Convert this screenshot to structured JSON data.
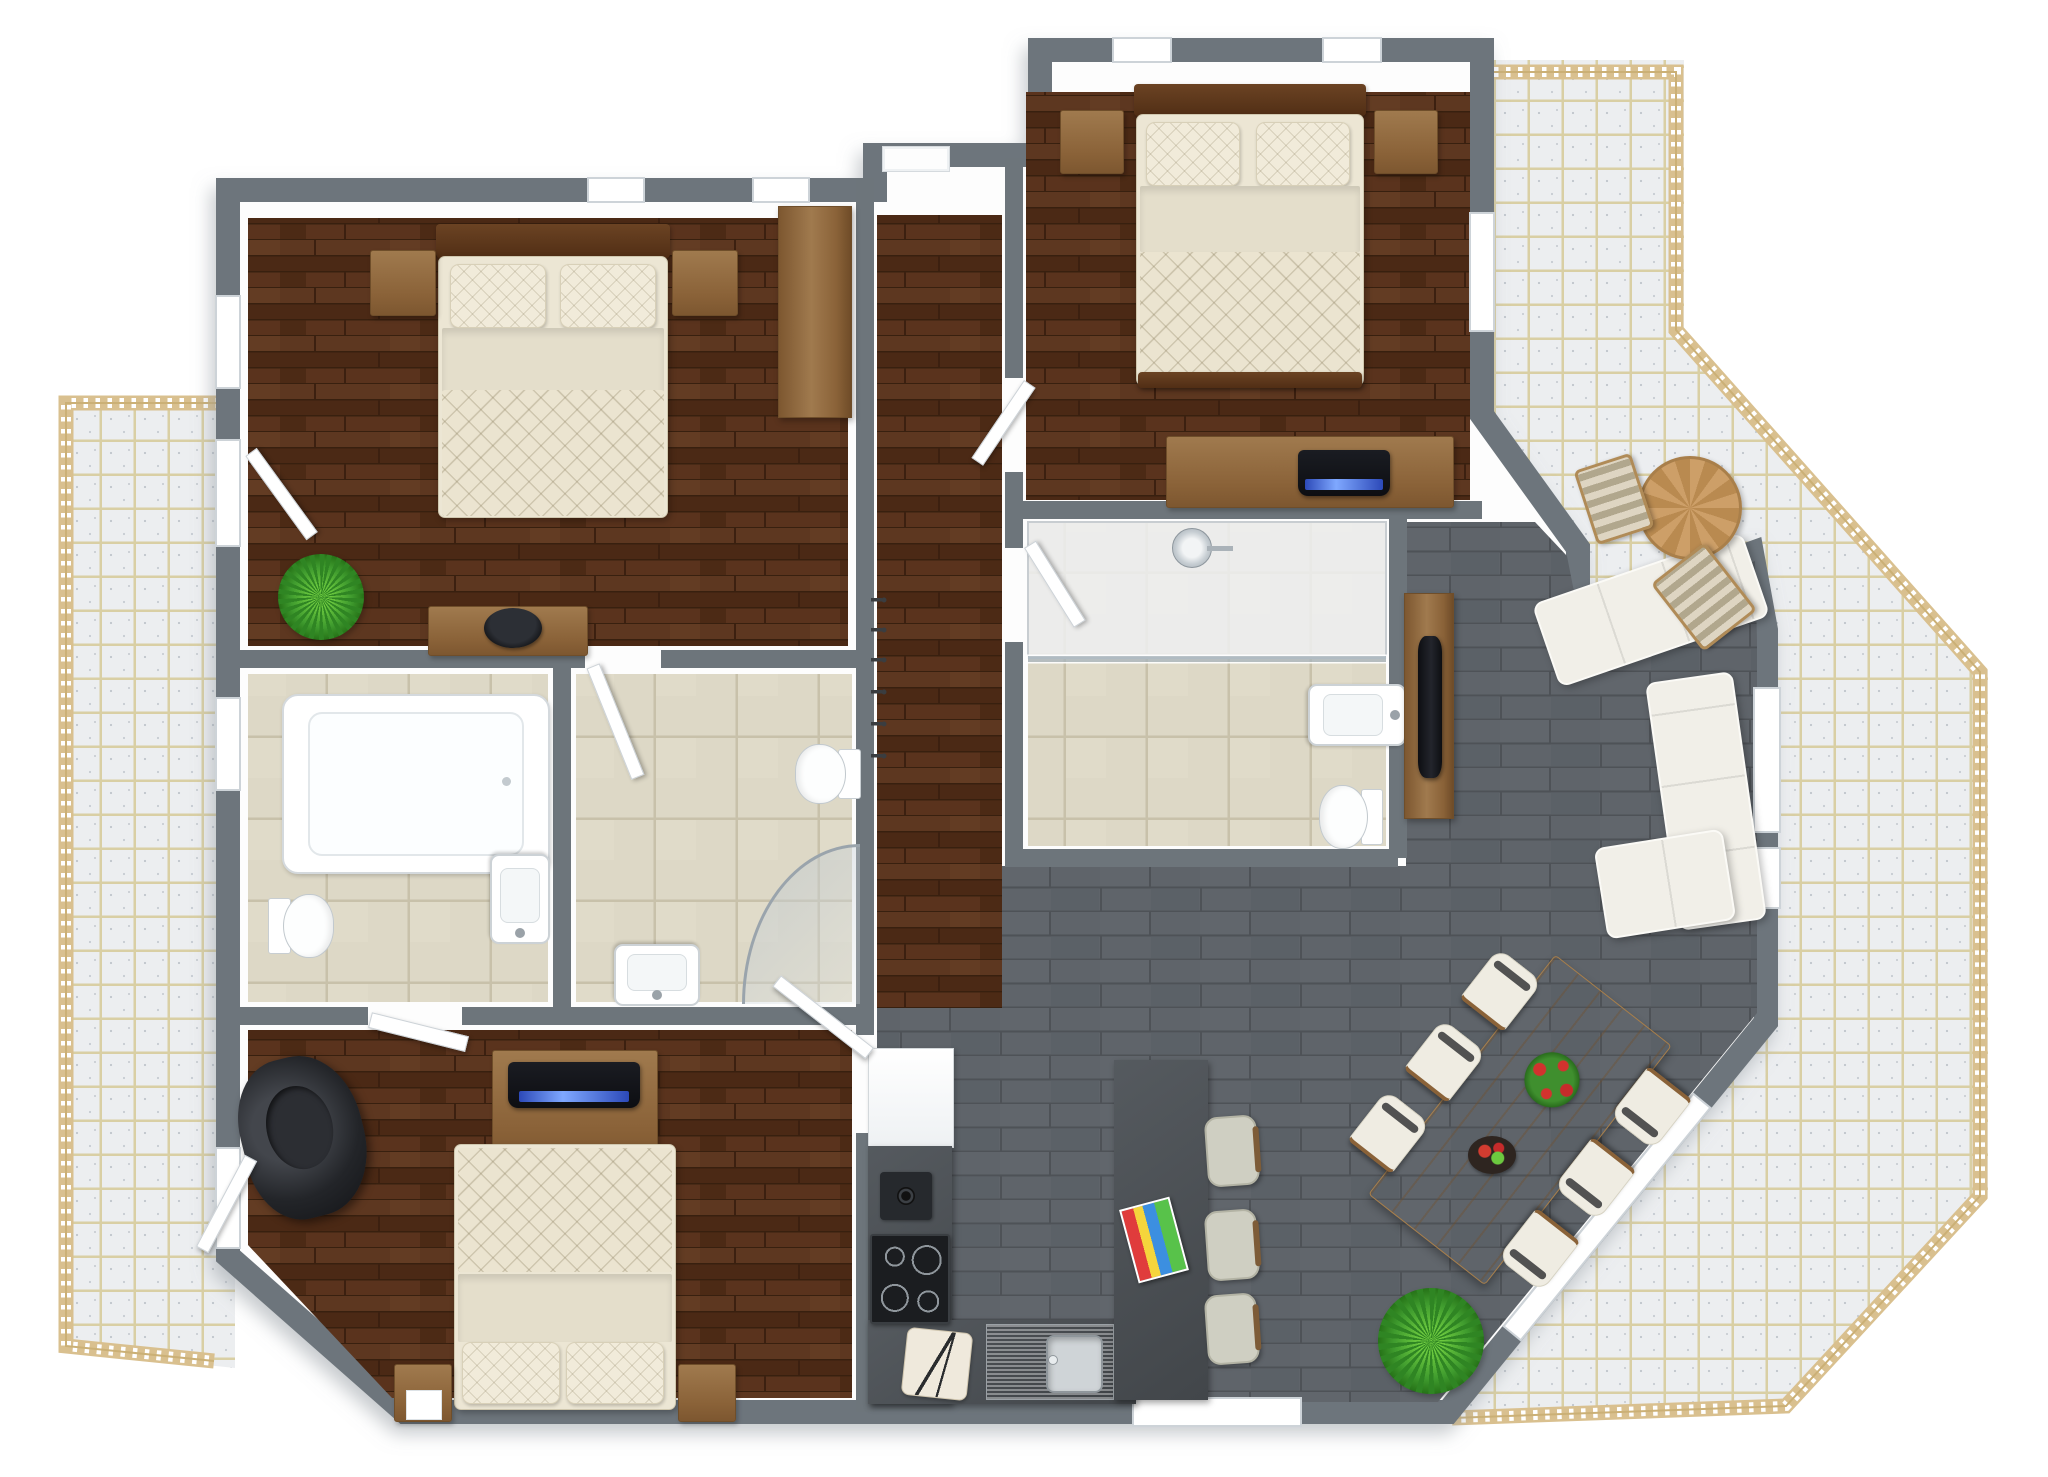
{
  "meta": {
    "title": "3D apartment floor plan render, top-down view",
    "style": "photorealistic 3D floor plan on white background, no text labels"
  },
  "palette": {
    "wall_gray": "#6d757b",
    "inner_wall_white": "#fdfdfd",
    "bedroom_wood_floor": "#54301c",
    "living_tile_gray": "#5f646a",
    "bathroom_tile_beige": "#ddd8c6",
    "balcony_glass_block": "#eceef0",
    "balcony_grout_tan": "#d9cfa4",
    "railing_wood": "#d9c08f",
    "bedding_cream": "#ebe4d0",
    "furniture_wood": "#9a7246",
    "dark_headboard_wood": "#5e3a22",
    "kitchen_counter_dark": "#4a4e52",
    "sofa_cream": "#f1efe8",
    "tv_screen_blue": "#3a58c8",
    "plant_green": "#3f9b2e",
    "black_armchair": "#1f2124"
  },
  "rooms": [
    {
      "id": "bedroom-top-left",
      "floor": "dark wood",
      "contents": "double bed, two nightstands, wardrobe, dresser with bowl, plant"
    },
    {
      "id": "bedroom-top-right",
      "floor": "dark wood",
      "contents": "double bed, two nightstands, desk with laptop"
    },
    {
      "id": "bedroom-bottom-left",
      "floor": "dark wood",
      "contents": "double bed, two nightstands, TV sideboard, black armchair"
    },
    {
      "id": "bathroom-left",
      "floor": "beige tile",
      "contents": "bathtub, toilet, sink"
    },
    {
      "id": "bathroom-middle",
      "floor": "beige tile",
      "contents": "corner shower, toilet, sink, door"
    },
    {
      "id": "bathroom-right",
      "floor": "beige tile",
      "contents": "walk-in shower, sink, toilet"
    },
    {
      "id": "hallway",
      "floor": "dark wood",
      "contents": "entry door, coat hooks"
    },
    {
      "id": "kitchen-living-dining",
      "floor": "gray tile",
      "contents": "kitchen counter, fridge, cooktop, sink, island with 3 stools and magazines, dining table with 6 chairs, corner sofa, TV cabinet, plants"
    },
    {
      "id": "balconies",
      "floor": "glass-block tile",
      "contents": "wood railing, round table with two striped chairs"
    }
  ],
  "scene": {
    "items": [
      {
        "n": "bed-1-headboard",
        "t": "wood-dark",
        "x": 436,
        "y": 224,
        "w": 234,
        "h": 34
      },
      {
        "n": "bed-1-mattress",
        "t": "mattress",
        "x": 438,
        "y": 256,
        "w": 230,
        "h": 262
      },
      {
        "n": "bed-1-pillow-left",
        "t": "pillow",
        "x": 450,
        "y": 264,
        "w": 96,
        "h": 64
      },
      {
        "n": "bed-1-pillow-right",
        "t": "pillow",
        "x": 560,
        "y": 264,
        "w": 96,
        "h": 64
      },
      {
        "n": "bed-1-sheet",
        "t": "sheet",
        "x": 442,
        "y": 328,
        "w": 222,
        "h": 64
      },
      {
        "n": "bed-1-quilt",
        "t": "quilt",
        "x": 442,
        "y": 390,
        "w": 222,
        "h": 126
      },
      {
        "n": "nightstand-bed1-left",
        "t": "wood",
        "x": 370,
        "y": 250,
        "w": 66,
        "h": 66
      },
      {
        "n": "nightstand-bed1-right",
        "t": "wood",
        "x": 672,
        "y": 250,
        "w": 66,
        "h": 66
      },
      {
        "n": "wardrobe-bedroom1",
        "t": "wood-v",
        "x": 778,
        "y": 206,
        "w": 74,
        "h": 212
      },
      {
        "n": "dresser-bedroom1",
        "t": "wood",
        "x": 428,
        "y": 606,
        "w": 160,
        "h": 50
      },
      {
        "n": "decor-bowl-bedroom1",
        "t": "dark-bowl",
        "x": 484,
        "y": 608,
        "w": 58,
        "h": 40
      },
      {
        "n": "plant-bedroom1",
        "t": "plant",
        "x": 278,
        "y": 554,
        "w": 86,
        "h": 86
      },
      {
        "n": "bed-2-headboard",
        "t": "wood-dark",
        "x": 1134,
        "y": 84,
        "w": 232,
        "h": 32
      },
      {
        "n": "bed-2-mattress",
        "t": "mattress",
        "x": 1136,
        "y": 114,
        "w": 228,
        "h": 272
      },
      {
        "n": "bed-2-pillow-left",
        "t": "pillow",
        "x": 1146,
        "y": 122,
        "w": 94,
        "h": 64
      },
      {
        "n": "bed-2-pillow-right",
        "t": "pillow",
        "x": 1256,
        "y": 122,
        "w": 94,
        "h": 64
      },
      {
        "n": "bed-2-sheet",
        "t": "sheet",
        "x": 1140,
        "y": 186,
        "w": 220,
        "h": 66
      },
      {
        "n": "bed-2-quilt",
        "t": "quilt",
        "x": 1140,
        "y": 252,
        "w": 220,
        "h": 122
      },
      {
        "n": "bed-2-footboard",
        "t": "wood-dark",
        "x": 1138,
        "y": 372,
        "w": 224,
        "h": 16
      },
      {
        "n": "nightstand-bed2-left",
        "t": "wood",
        "x": 1060,
        "y": 110,
        "w": 64,
        "h": 64
      },
      {
        "n": "nightstand-bed2-right",
        "t": "wood",
        "x": 1374,
        "y": 110,
        "w": 64,
        "h": 64
      },
      {
        "n": "desk-bedroom2",
        "t": "wood",
        "x": 1166,
        "y": 436,
        "w": 288,
        "h": 72
      },
      {
        "n": "laptop-bedroom2",
        "t": "dark-tv",
        "x": 1298,
        "y": 450,
        "w": 92,
        "h": 46
      },
      {
        "n": "tub-bathroom-left",
        "t": "tub",
        "x": 282,
        "y": 694,
        "w": 268,
        "h": 180
      },
      {
        "n": "toilet-bathroom-left",
        "t": "toilet",
        "x": 264,
        "y": 894,
        "w": 74,
        "h": 66,
        "r": -90
      },
      {
        "n": "sink-bathroom-left",
        "t": "sink",
        "x": 490,
        "y": 854,
        "w": 60,
        "h": 90,
        "r": 180
      },
      {
        "n": "toilet-bathroom-middle",
        "t": "toilet",
        "x": 794,
        "y": 740,
        "w": 68,
        "h": 66,
        "r": 90
      },
      {
        "n": "corner-shower-bathroom-middle",
        "t": "corner-shower",
        "x": 742,
        "y": 844,
        "w": 118,
        "h": 160
      },
      {
        "n": "sink-bathroom-middle",
        "t": "sink",
        "x": 614,
        "y": 944,
        "w": 86,
        "h": 62,
        "r": 180
      },
      {
        "n": "door-leaf-bathroom-middle",
        "t": "leaf",
        "x": 586,
        "y": 666,
        "w": 14,
        "h": 120,
        "r": -22,
        "o": "50% 0%"
      },
      {
        "n": "shower-glass-bathroom-right",
        "t": "glass-h",
        "x": 1028,
        "y": 656,
        "w": 358,
        "h": 6
      },
      {
        "n": "shower-head-bathroom-right",
        "t": "shower-head",
        "x": 1172,
        "y": 528,
        "w": 40,
        "h": 40
      },
      {
        "n": "sink-bathroom-right",
        "t": "sink",
        "x": 1326,
        "y": 666,
        "w": 62,
        "h": 98,
        "r": 90
      },
      {
        "n": "toilet-bathroom-right",
        "t": "toilet",
        "x": 1314,
        "y": 784,
        "w": 74,
        "h": 64,
        "r": 90
      },
      {
        "n": "armchair-bedroom3",
        "t": "armchair",
        "x": 242,
        "y": 1056,
        "w": 122,
        "h": 162,
        "r": -14
      },
      {
        "n": "tv-stand-bedroom3",
        "t": "wood",
        "x": 492,
        "y": 1050,
        "w": 166,
        "h": 114
      },
      {
        "n": "tv-bedroom3",
        "t": "dark-tv",
        "x": 508,
        "y": 1062,
        "w": 132,
        "h": 46
      },
      {
        "n": "bed-3-mattress",
        "t": "mattress",
        "x": 454,
        "y": 1144,
        "w": 222,
        "h": 266
      },
      {
        "n": "bed-3-quilt",
        "t": "quilt",
        "x": 458,
        "y": 1148,
        "w": 214,
        "h": 124
      },
      {
        "n": "bed-3-sheet",
        "t": "sheet",
        "x": 458,
        "y": 1274,
        "w": 214,
        "h": 68
      },
      {
        "n": "bed-3-pillow-left",
        "t": "pillow",
        "x": 462,
        "y": 1342,
        "w": 98,
        "h": 62
      },
      {
        "n": "bed-3-pillow-right",
        "t": "pillow",
        "x": 566,
        "y": 1342,
        "w": 98,
        "h": 62
      },
      {
        "n": "nightstand-bed3-left",
        "t": "wood",
        "x": 394,
        "y": 1364,
        "w": 58,
        "h": 58
      },
      {
        "n": "box-on-nightstand",
        "t": "white",
        "x": 406,
        "y": 1390,
        "w": 36,
        "h": 30
      },
      {
        "n": "nightstand-bed3-right",
        "t": "wood",
        "x": 678,
        "y": 1364,
        "w": 58,
        "h": 58
      },
      {
        "n": "fridge",
        "t": "fridge",
        "x": 868,
        "y": 1048,
        "w": 86,
        "h": 100
      },
      {
        "n": "kitchen-counter-west",
        "t": "counter",
        "x": 868,
        "y": 1146,
        "w": 84,
        "h": 258
      },
      {
        "n": "kitchen-counter-south",
        "t": "counter",
        "x": 868,
        "y": 1320,
        "w": 268,
        "h": 84
      },
      {
        "n": "coffee-machine",
        "t": "coffee",
        "x": 880,
        "y": 1172,
        "w": 52,
        "h": 48
      },
      {
        "n": "cooktop",
        "t": "cooktop",
        "x": 870,
        "y": 1234,
        "w": 80,
        "h": 90
      },
      {
        "n": "cutting-board",
        "t": "board",
        "x": 904,
        "y": 1330,
        "w": 66,
        "h": 68,
        "r": 6
      },
      {
        "n": "kitchen-sink",
        "t": "ksink",
        "x": 986,
        "y": 1324,
        "w": 128,
        "h": 76
      },
      {
        "n": "kitchen-island",
        "t": "counter",
        "x": 1114,
        "y": 1060,
        "w": 94,
        "h": 340
      },
      {
        "n": "magazines",
        "t": "mags",
        "x": 1128,
        "y": 1202,
        "w": 52,
        "h": 76,
        "r": -15
      },
      {
        "n": "bar-stool-1",
        "t": "stool",
        "x": 1206,
        "y": 1116,
        "w": 52,
        "h": 70,
        "r": -4
      },
      {
        "n": "bar-stool-2",
        "t": "stool",
        "x": 1206,
        "y": 1210,
        "w": 52,
        "h": 70,
        "r": -4
      },
      {
        "n": "bar-stool-3",
        "t": "stool",
        "x": 1206,
        "y": 1294,
        "w": 52,
        "h": 70,
        "r": -4
      },
      {
        "n": "tv-cabinet-living",
        "t": "wood-v",
        "x": 1404,
        "y": 593,
        "w": 50,
        "h": 226
      },
      {
        "n": "tv-living",
        "t": "tv-v",
        "x": 1418,
        "y": 636,
        "w": 24,
        "h": 142
      },
      {
        "n": "sofa-back-section",
        "t": "sofa",
        "x": 1540,
        "y": 566,
        "w": 222,
        "h": 88,
        "r": -19
      },
      {
        "n": "sofa-side-section",
        "t": "sofa-v",
        "x": 1662,
        "y": 676,
        "w": 88,
        "h": 250,
        "r": -8
      },
      {
        "n": "sofa-chaise",
        "t": "sofa",
        "x": 1600,
        "y": 838,
        "w": 130,
        "h": 92,
        "r": -9
      },
      {
        "n": "dining-table",
        "t": "table-wood",
        "x": 1446,
        "y": 968,
        "w": 148,
        "h": 304,
        "r": 38
      },
      {
        "n": "dining-chair-1",
        "t": "chair",
        "x": 1361,
        "y": 1100,
        "w": 56,
        "h": 64,
        "r": 38
      },
      {
        "n": "dining-chair-2",
        "t": "chair",
        "x": 1417,
        "y": 1029,
        "w": 56,
        "h": 64,
        "r": 38
      },
      {
        "n": "dining-chair-3",
        "t": "chair",
        "x": 1473,
        "y": 958,
        "w": 56,
        "h": 64,
        "r": 38
      },
      {
        "n": "dining-chair-4",
        "t": "chair",
        "x": 1511,
        "y": 1218,
        "w": 56,
        "h": 64,
        "r": 218
      },
      {
        "n": "dining-chair-5",
        "t": "chair",
        "x": 1567,
        "y": 1147,
        "w": 56,
        "h": 64,
        "r": 218
      },
      {
        "n": "dining-chair-6",
        "t": "chair",
        "x": 1623,
        "y": 1076,
        "w": 56,
        "h": 64,
        "r": 218
      },
      {
        "n": "table-flowers",
        "t": "flowers",
        "x": 1524,
        "y": 1052,
        "w": 56,
        "h": 58
      },
      {
        "n": "fruit-bowl",
        "t": "fruit",
        "x": 1468,
        "y": 1136,
        "w": 48,
        "h": 38
      },
      {
        "n": "plant-living",
        "t": "plant",
        "x": 1378,
        "y": 1288,
        "w": 106,
        "h": 106
      },
      {
        "n": "balcony-round-table",
        "t": "round-table",
        "x": 1638,
        "y": 456,
        "w": 104,
        "h": 104
      },
      {
        "n": "balcony-chair-1",
        "t": "bchair",
        "x": 1584,
        "y": 460,
        "w": 60,
        "h": 78,
        "r": -18
      },
      {
        "n": "balcony-chair-2",
        "t": "bchair",
        "x": 1670,
        "y": 554,
        "w": 68,
        "h": 86,
        "r": -38
      },
      {
        "n": "entry-door",
        "t": "doorway",
        "x": 882,
        "y": 146,
        "w": 68,
        "h": 26
      },
      {
        "n": "door-leaf-bedroom2",
        "t": "leaf",
        "x": 1024,
        "y": 380,
        "w": 14,
        "h": 94,
        "r": 34,
        "o": "0% 0%"
      },
      {
        "n": "door-leaf-bathroom-right",
        "t": "leaf",
        "x": 1024,
        "y": 548,
        "w": 14,
        "h": 94,
        "r": -32,
        "o": "0% 0%"
      },
      {
        "n": "door-leaf-bathroom-left",
        "t": "leaf",
        "x": 370,
        "y": 1012,
        "w": 100,
        "h": 16,
        "r": 14,
        "o": "0% 50%"
      },
      {
        "n": "door-leaf-bedroom3-entry",
        "t": "leaf",
        "x": 756,
        "y": 1048,
        "w": 118,
        "h": 14,
        "r": 38,
        "o": "100% 0%"
      },
      {
        "n": "door-leaf-bedroom1-balcony",
        "t": "leaf",
        "x": 244,
        "y": 452,
        "w": 14,
        "h": 104,
        "r": -36,
        "o": "50% 0%"
      },
      {
        "n": "door-leaf-bedroom3-balcony",
        "t": "leaf",
        "x": 244,
        "y": 1158,
        "w": 14,
        "h": 104,
        "r": 28,
        "o": "50% 0%"
      }
    ]
  }
}
